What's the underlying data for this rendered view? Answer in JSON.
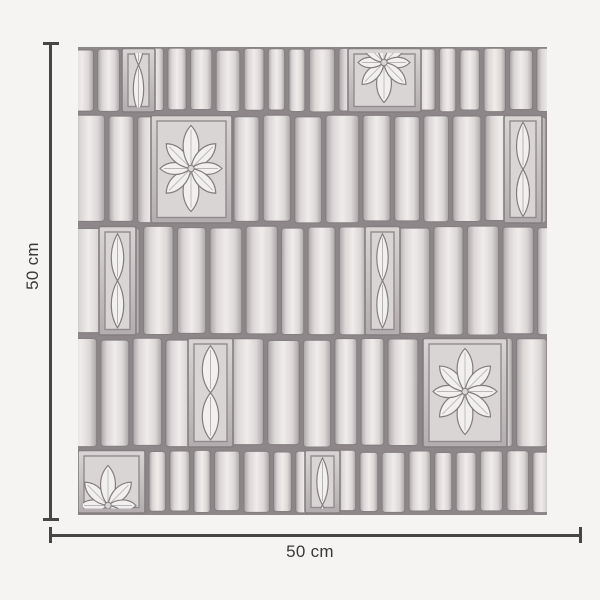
{
  "background": "#f5f4f2",
  "annotation": {
    "height_label": "50 cm",
    "width_label": "50 cm",
    "line_color": "#474645",
    "text_color": "#3a3937"
  },
  "swatch": {
    "width": 469,
    "height": 468,
    "description": "grayscale hand-sketched tile wallpaper: bands of vertical ribbed tiles with square flower medallions and narrow ogee-leaf panels",
    "palette": {
      "gap": "#8d8789",
      "strip_light": "#efeceb",
      "strip_mid": "#dbd7d6",
      "strip_edge": "#aaa4a6",
      "outline": "#847f81",
      "panel_frame_top": "#d9d5d4",
      "panel_frame_bottom": "#b3adaf",
      "panel_field": "#d9d5d4",
      "inner_line": "#918b8d",
      "motif_fill": "#f2f0ef",
      "motif_stroke": "#837d7f"
    },
    "bands": [
      {
        "h": 67,
        "seed": 11,
        "strip_min": 16,
        "strip_max": 26,
        "medallions": [
          {
            "type": "ogee",
            "x": 44,
            "w": 33,
            "shift": -36
          },
          {
            "type": "flower",
            "x": 270,
            "w": 73,
            "flower": {
              "cx": 36,
              "cy": 14,
              "rv": 40,
              "rh": 26,
              "rd": 31
            }
          }
        ]
      },
      {
        "h": 111,
        "seed": 23,
        "strip_min": 22,
        "strip_max": 34,
        "medallions": [
          {
            "type": "flower",
            "x": 73,
            "w": 81,
            "flower": {
              "cx": 40,
              "cy": 53,
              "rv": 43,
              "rh": 31,
              "rd": 35
            }
          },
          {
            "type": "ogee",
            "x": 426,
            "w": 38
          }
        ]
      },
      {
        "h": 112,
        "seed": 37,
        "strip_min": 22,
        "strip_max": 34,
        "medallions": [
          {
            "type": "ogee",
            "x": 21,
            "w": 37
          },
          {
            "type": "ogee",
            "x": 287,
            "w": 35
          }
        ]
      },
      {
        "h": 112,
        "seed": 45,
        "strip_min": 22,
        "strip_max": 34,
        "medallions": [
          {
            "type": "ogee",
            "x": 110,
            "w": 45
          },
          {
            "type": "flower",
            "x": 345,
            "w": 84,
            "flower": {
              "cx": 42,
              "cy": 53,
              "rv": 43,
              "rh": 32,
              "rd": 36
            }
          }
        ]
      },
      {
        "h": 66,
        "seed": 58,
        "strip_min": 16,
        "strip_max": 26,
        "medallions": [
          {
            "type": "flower",
            "x": 0,
            "w": 67,
            "flower": {
              "cx": 30,
              "cy": 55,
              "rv": 40,
              "rh": 28,
              "rd": 33
            }
          },
          {
            "type": "ogee",
            "x": 227,
            "w": 35,
            "shift": 2
          }
        ]
      }
    ]
  }
}
